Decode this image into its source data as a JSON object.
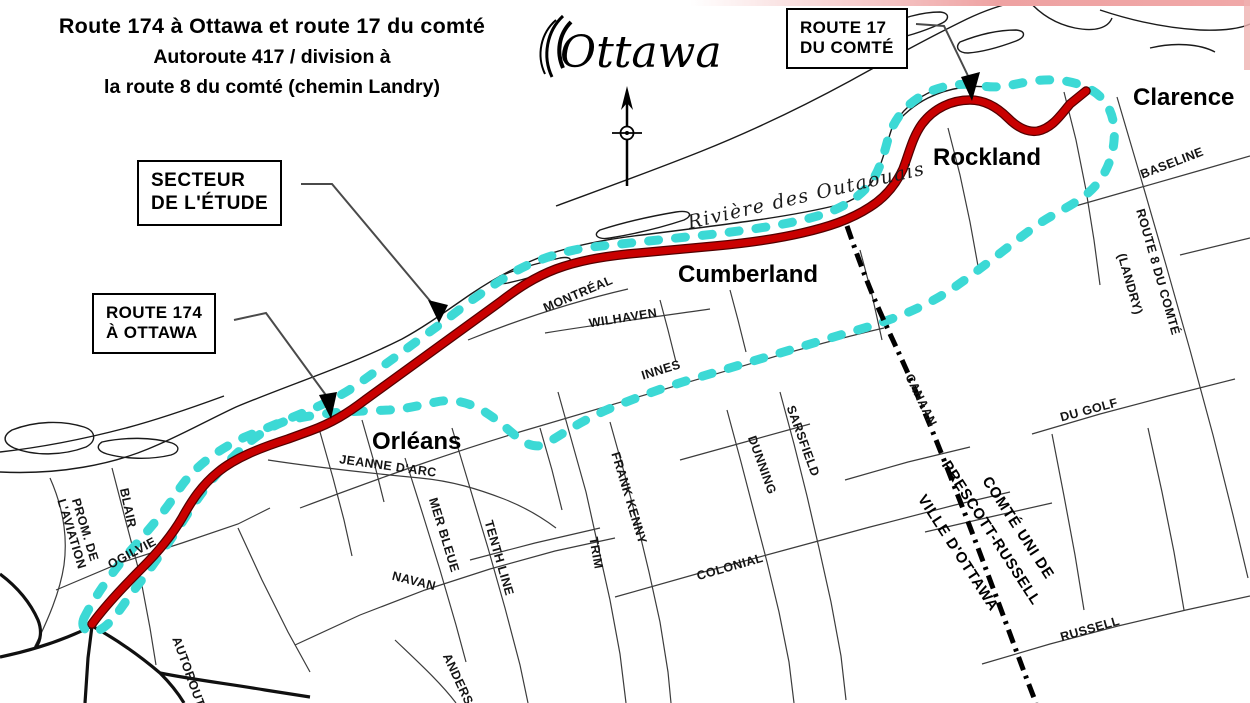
{
  "map": {
    "title": {
      "line1": "Route 174 à Ottawa et route 17 du comté",
      "line2": "Autoroute 417 / division à",
      "line3": "la route 8 du comté (chemin Landry)"
    },
    "logo": {
      "text": "Ottawa"
    },
    "callouts": {
      "secteur": {
        "line1": "SECTEUR",
        "line2": "DE L'ÉTUDE"
      },
      "route174": {
        "line1": "ROUTE 174",
        "line2": "À OTTAWA"
      },
      "route17": {
        "line1": "ROUTE 17",
        "line2": "DU COMTÉ"
      }
    },
    "places": {
      "orleans": "Orléans",
      "cumberland": "Cumberland",
      "rockland": "Rockland",
      "clarence": "Clarence"
    },
    "river": "Rivière des Outaouais",
    "roads": {
      "prom1": "PROM. DE",
      "prom2": "L'AVIATION",
      "blair": "BLAIR",
      "ogilvie": "OGILVIE",
      "autoroute": "AUTOROUTE",
      "anderson": "ANDERSON",
      "jeanne_darc": "JEANNE D'ARC",
      "mer_bleue": "MER BLEUE",
      "tenth_line": "TENTH LINE",
      "navan": "NAVAN",
      "trim": "TRIM",
      "frank_kenny": "FRANK KENNY",
      "innes": "INNES",
      "wilhaven": "WILHAVEN",
      "montreal": "MONTRÉAL",
      "colonial": "COLONIAL",
      "dunning": "DUNNING",
      "sarsfield": "SARSFIELD",
      "canaan": "CANAAN",
      "baseline": "BASELINE",
      "route8": "ROUTE 8 DU COMTÉ",
      "landry": "(LANDRY)",
      "du_golf": "DU GOLF",
      "russell": "RUSSELL"
    },
    "boundary_labels": {
      "comte_uni": "COMTÉ UNI DE",
      "prescott_russell": "PRESCOTT-RUSSELL",
      "ville_ottawa": "VILLE D'OTTAWA"
    },
    "colors": {
      "red": "#c90000",
      "cyan": "#3cd9d5",
      "boundary": "#000000"
    },
    "routes": {
      "red_path": "M 92,624 C 105,606 125,585 142,568 C 160,550 172,535 182,518 C 192,500 202,485 218,472 C 235,458 260,448 288,439 L 310,431 C 332,423 348,413 365,400 L 500,302 C 518,288 535,277 556,269 C 578,261 600,257 628,254 L 715,246 C 748,243 776,239 802,233 C 828,227 850,220 870,207 C 886,197 896,184 903,169 C 909,154 912,138 922,124 C 934,108 952,100 970,100 C 986,100 998,108 1008,118 C 1016,126 1026,133 1038,131 C 1052,128 1060,116 1070,104 L 1086,91",
      "cyan_path": "M 84,618 C 96,594 114,570 132,549 C 151,527 165,511 178,491 C 192,469 215,451 245,437 L 298,415 C 325,404 343,395 361,382 L 446,320 C 470,301 492,285 516,271 C 536,260 562,251 592,247 L 715,234 C 756,229 791,224 821,215 C 846,207 862,195 872,181 C 880,169 884,154 888,139 C 893,121 905,105 923,95 C 941,85 963,82 983,86 C 1000,89 1014,84 1032,81 C 1056,78 1077,81 1093,91 C 1109,101 1116,119 1114,141 C 1112,164 1101,184 1083,197 C 1065,210 1048,216 1029,231 C 1010,245 985,266 952,289 C 922,309 887,322 847,333 L 703,376 C 667,386 641,396 616,406 C 591,416 571,428 549,442 C 539,449 528,446 517,437 C 505,427 491,414 476,407 C 463,401 449,399 436,402 C 421,405 406,409 389,410 L 341,412 C 321,414 301,417 286,421 C 263,429 246,444 229,461 C 211,479 197,499 183,521 C 166,547 149,571 131,594 C 119,611 109,627 97,631 C 87,634 80,628 84,618 Z",
      "boundary_path": "M 847,226 C 856,252 866,280 877,305 C 891,337 904,363 916,392 C 929,422 941,452 953,483 C 966,516 978,548 990,580 C 1002,612 1014,645 1026,677 L 1036,703"
    }
  }
}
